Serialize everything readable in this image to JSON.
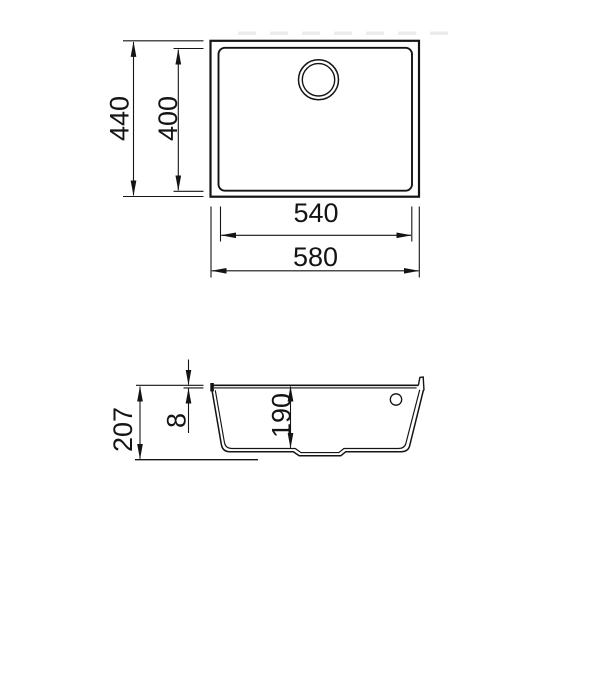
{
  "drawing": {
    "background_color": "#ffffff",
    "line_color": "#141414",
    "top_view": {
      "overall_width_label": "580",
      "inner_width_label": "540",
      "overall_depth_label": "440",
      "inner_depth_label": "400"
    },
    "section_view": {
      "overall_height_label": "207",
      "rim_thickness_label": "8",
      "bowl_depth_label": "190"
    }
  }
}
